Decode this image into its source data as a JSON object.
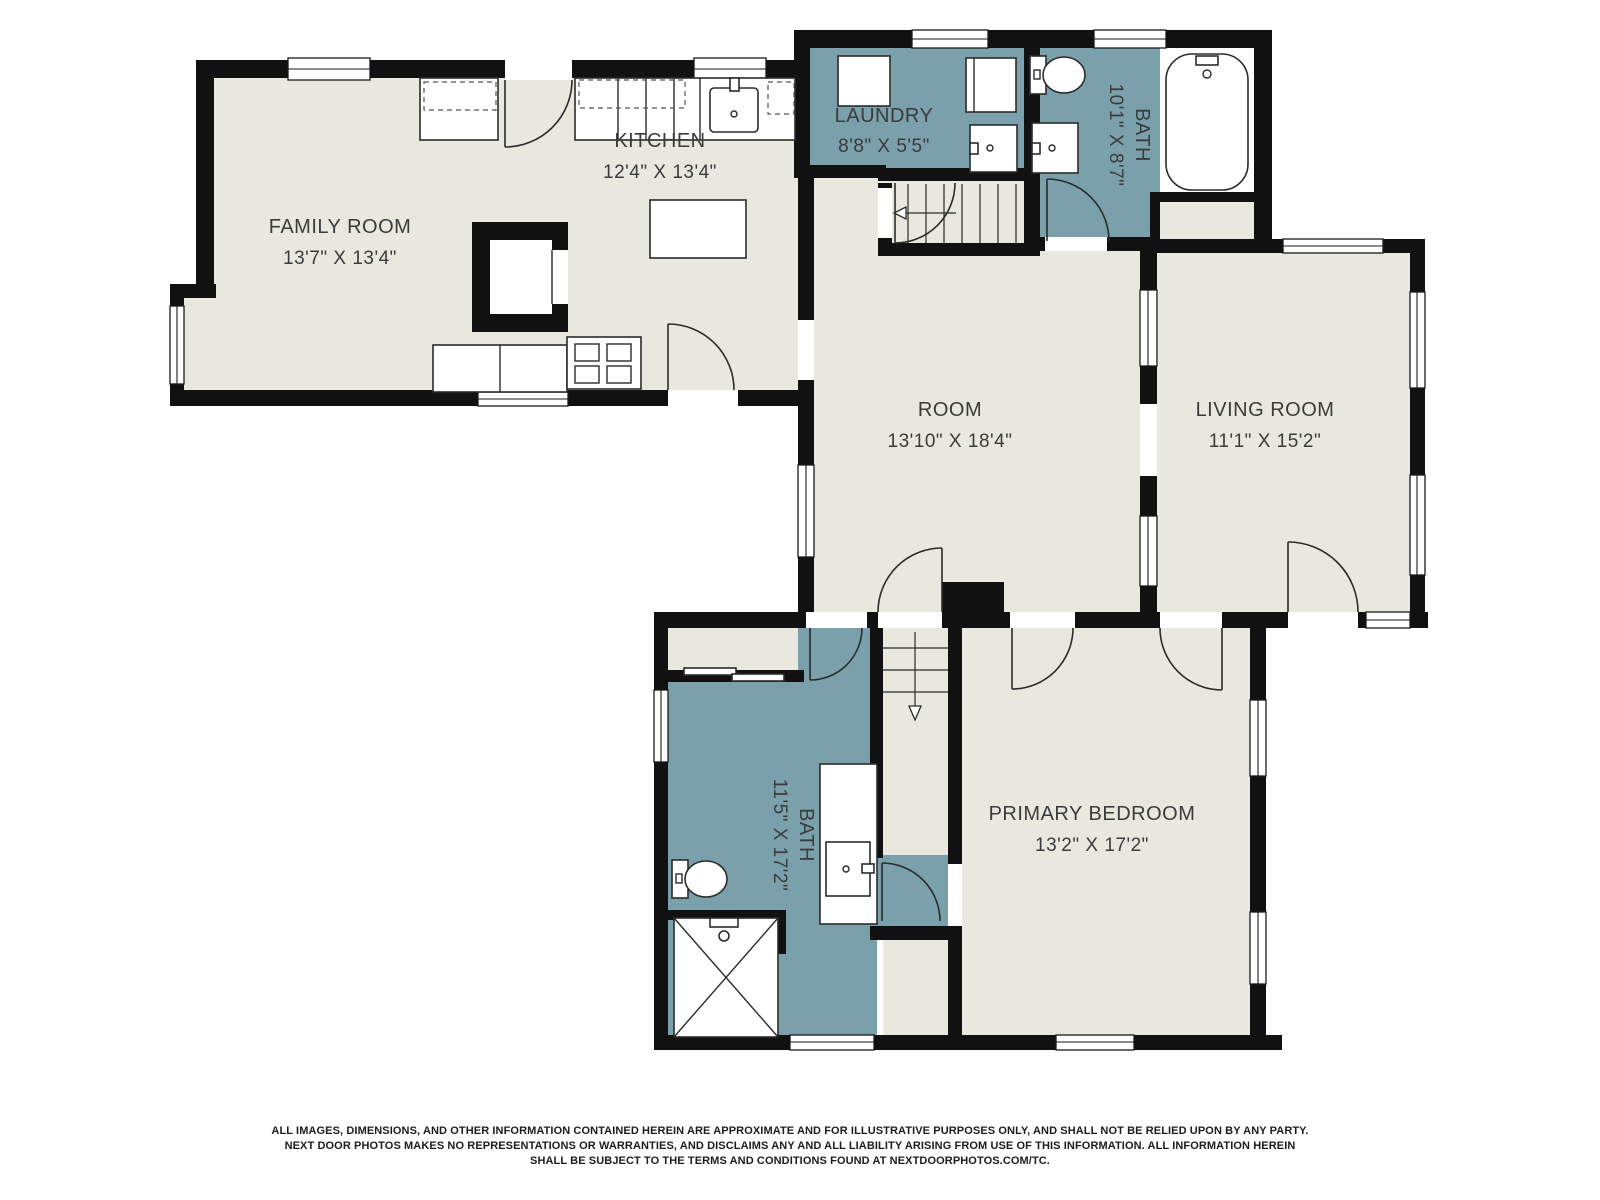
{
  "title": "Next Door Photos floor plan",
  "colors": {
    "background": "#ffffff",
    "room_fill": "#e9e8df",
    "wet_room_fill": "#7aa0ac",
    "wall": "#111111",
    "label_text": "#3b3b3b"
  },
  "rooms": {
    "family_room": {
      "name": "FAMILY ROOM",
      "dims": "13'7\" X 13'4\""
    },
    "kitchen": {
      "name": "KITCHEN",
      "dims": "12'4\" X 13'4\""
    },
    "laundry": {
      "name": "LAUNDRY",
      "dims": "8'8\" X 5'5\""
    },
    "bath_upper": {
      "name": "BATH",
      "dims": "10'1\" X 8'7\""
    },
    "room": {
      "name": "ROOM",
      "dims": "13'10\" X 18'4\""
    },
    "living_room": {
      "name": "LIVING ROOM",
      "dims": "11'1\" X 15'2\""
    },
    "bath_lower": {
      "name": "BATH",
      "dims": "11'5\" X 17'2\""
    },
    "primary_bedroom": {
      "name": "PRIMARY BEDROOM",
      "dims": "13'2\" X 17'2\""
    }
  },
  "disclaimer": {
    "line1": "ALL IMAGES, DIMENSIONS, AND OTHER INFORMATION CONTAINED HEREIN ARE APPROXIMATE AND FOR ILLUSTRATIVE PURPOSES ONLY, AND SHALL NOT BE RELIED UPON BY ANY PARTY.",
    "line2": "NEXT DOOR PHOTOS MAKES NO REPRESENTATIONS OR WARRANTIES, AND DISCLAIMS ANY AND ALL LIABILITY ARISING FROM USE OF THIS INFORMATION. ALL INFORMATION HEREIN",
    "line3": "SHALL BE SUBJECT TO THE TERMS AND CONDITIONS FOUND AT NEXTDOORPHOTOS.COM/TC."
  }
}
